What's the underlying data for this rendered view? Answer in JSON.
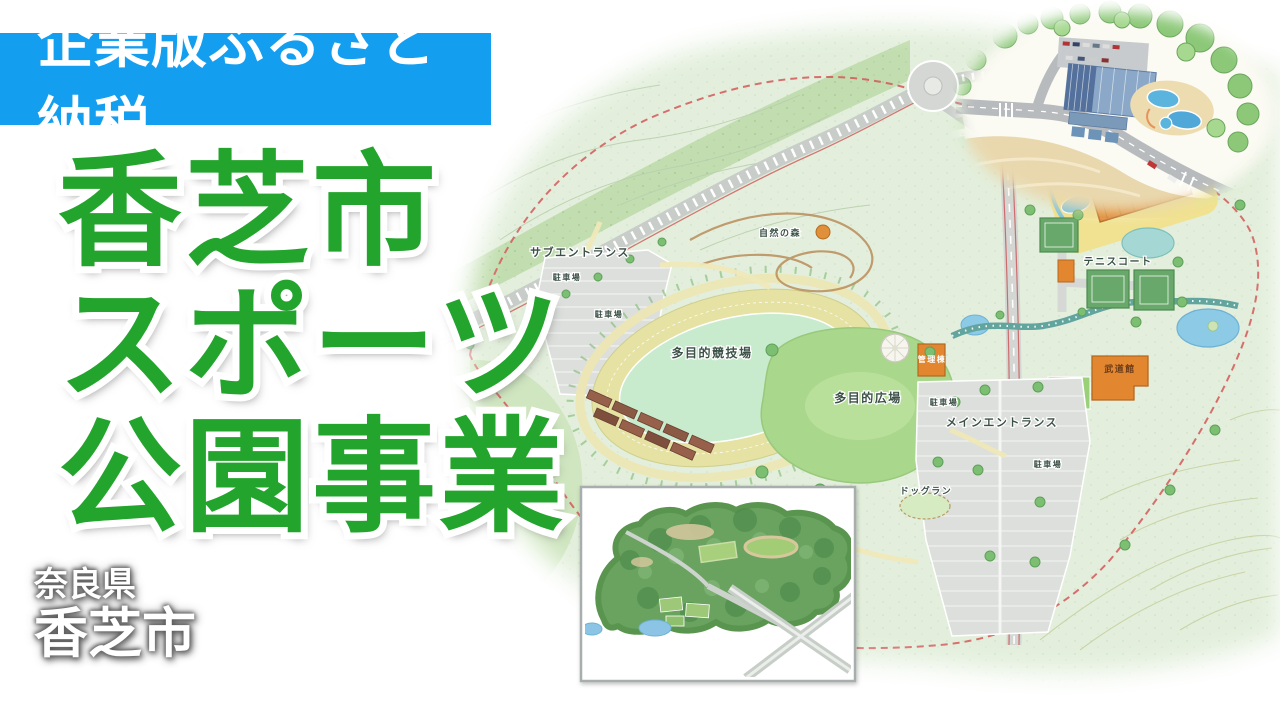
{
  "banner": {
    "label": "企業版ふるさと納税"
  },
  "title": {
    "line1": "香芝市",
    "line2": "スポーツ",
    "line3": "公園事業"
  },
  "location": {
    "prefecture": "奈良県",
    "city": "香芝市"
  },
  "colors": {
    "banner_blue": "#149ef0",
    "title_green": "#23a42d",
    "map_base_green": "#e3efdc",
    "boundary_red": "#d45858",
    "building_orange": "#e2862f",
    "water_blue": "#8ccae6"
  },
  "map": {
    "labels": [
      {
        "text": "サブエントランス",
        "x": 580,
        "y": 256,
        "size": 11
      },
      {
        "text": "自然の森",
        "x": 780,
        "y": 236,
        "size": 9
      },
      {
        "text": "多目的競技場",
        "x": 712,
        "y": 357,
        "size": 12
      },
      {
        "text": "多目的広場",
        "x": 868,
        "y": 402,
        "size": 12
      },
      {
        "text": "メインエントランス",
        "x": 1002,
        "y": 426,
        "size": 11
      },
      {
        "text": "テニスコート",
        "x": 1118,
        "y": 265,
        "size": 10
      },
      {
        "text": "武道館",
        "x": 1120,
        "y": 372,
        "size": 9,
        "fill": "#6b3c1a"
      },
      {
        "text": "管理棟",
        "x": 932,
        "y": 362,
        "size": 8,
        "fill": "#ffffff"
      },
      {
        "text": "ドッグラン",
        "x": 926,
        "y": 494,
        "size": 9
      },
      {
        "text": "駐車場",
        "x": 567,
        "y": 280,
        "size": 8
      },
      {
        "text": "駐車場",
        "x": 609,
        "y": 317,
        "size": 8
      },
      {
        "text": "駐車場",
        "x": 944,
        "y": 405,
        "size": 8
      },
      {
        "text": "駐車場",
        "x": 1048,
        "y": 467,
        "size": 8
      }
    ]
  }
}
